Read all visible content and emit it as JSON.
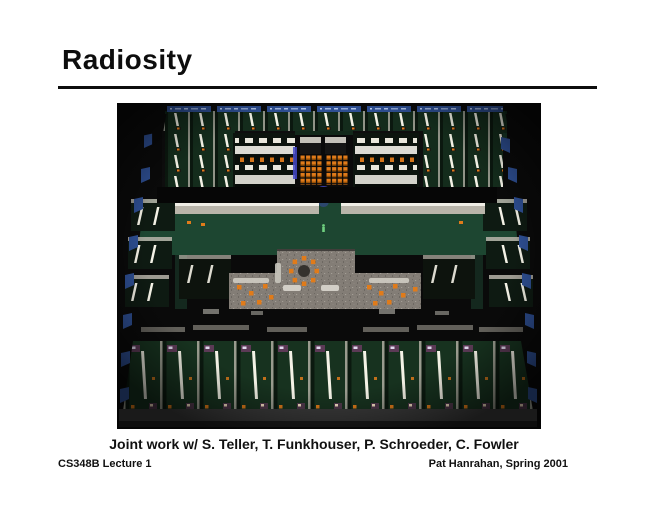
{
  "slide": {
    "title": "Radiosity",
    "caption": "Joint work w/ S. Teller, T. Funkhouser, P. Schroeder, C. Fowler",
    "footer_left": "CS348B Lecture 1",
    "footer_right": "Pat Hanrahan, Spring 2001"
  },
  "figure": {
    "alt": "Radiosity rendering of a full building floor seen from above: rows of offices with fluorescent tube lights and green floors, two bright conference rooms, a central auditorium with orange seats, a terrazzo lounge with a ring of orange chairs, and blue windows along the outer walls",
    "colors": {
      "bg": "#0a0a0a",
      "orange": "#e07b1a",
      "tube": "#f4f2e6",
      "wall": "#b9b5aa",
      "tableW": "#e9e7df",
      "floor1": "#142c1c",
      "floor2": "#17321f",
      "corridor": "#1d4631",
      "terrazzo": "#837d76",
      "blueWin": "#2e4f93",
      "blueGlow": "#4449c8",
      "purple": "#5c3a56",
      "person": "#6fcf7f",
      "bottomWall": "#3a3a3a"
    }
  }
}
